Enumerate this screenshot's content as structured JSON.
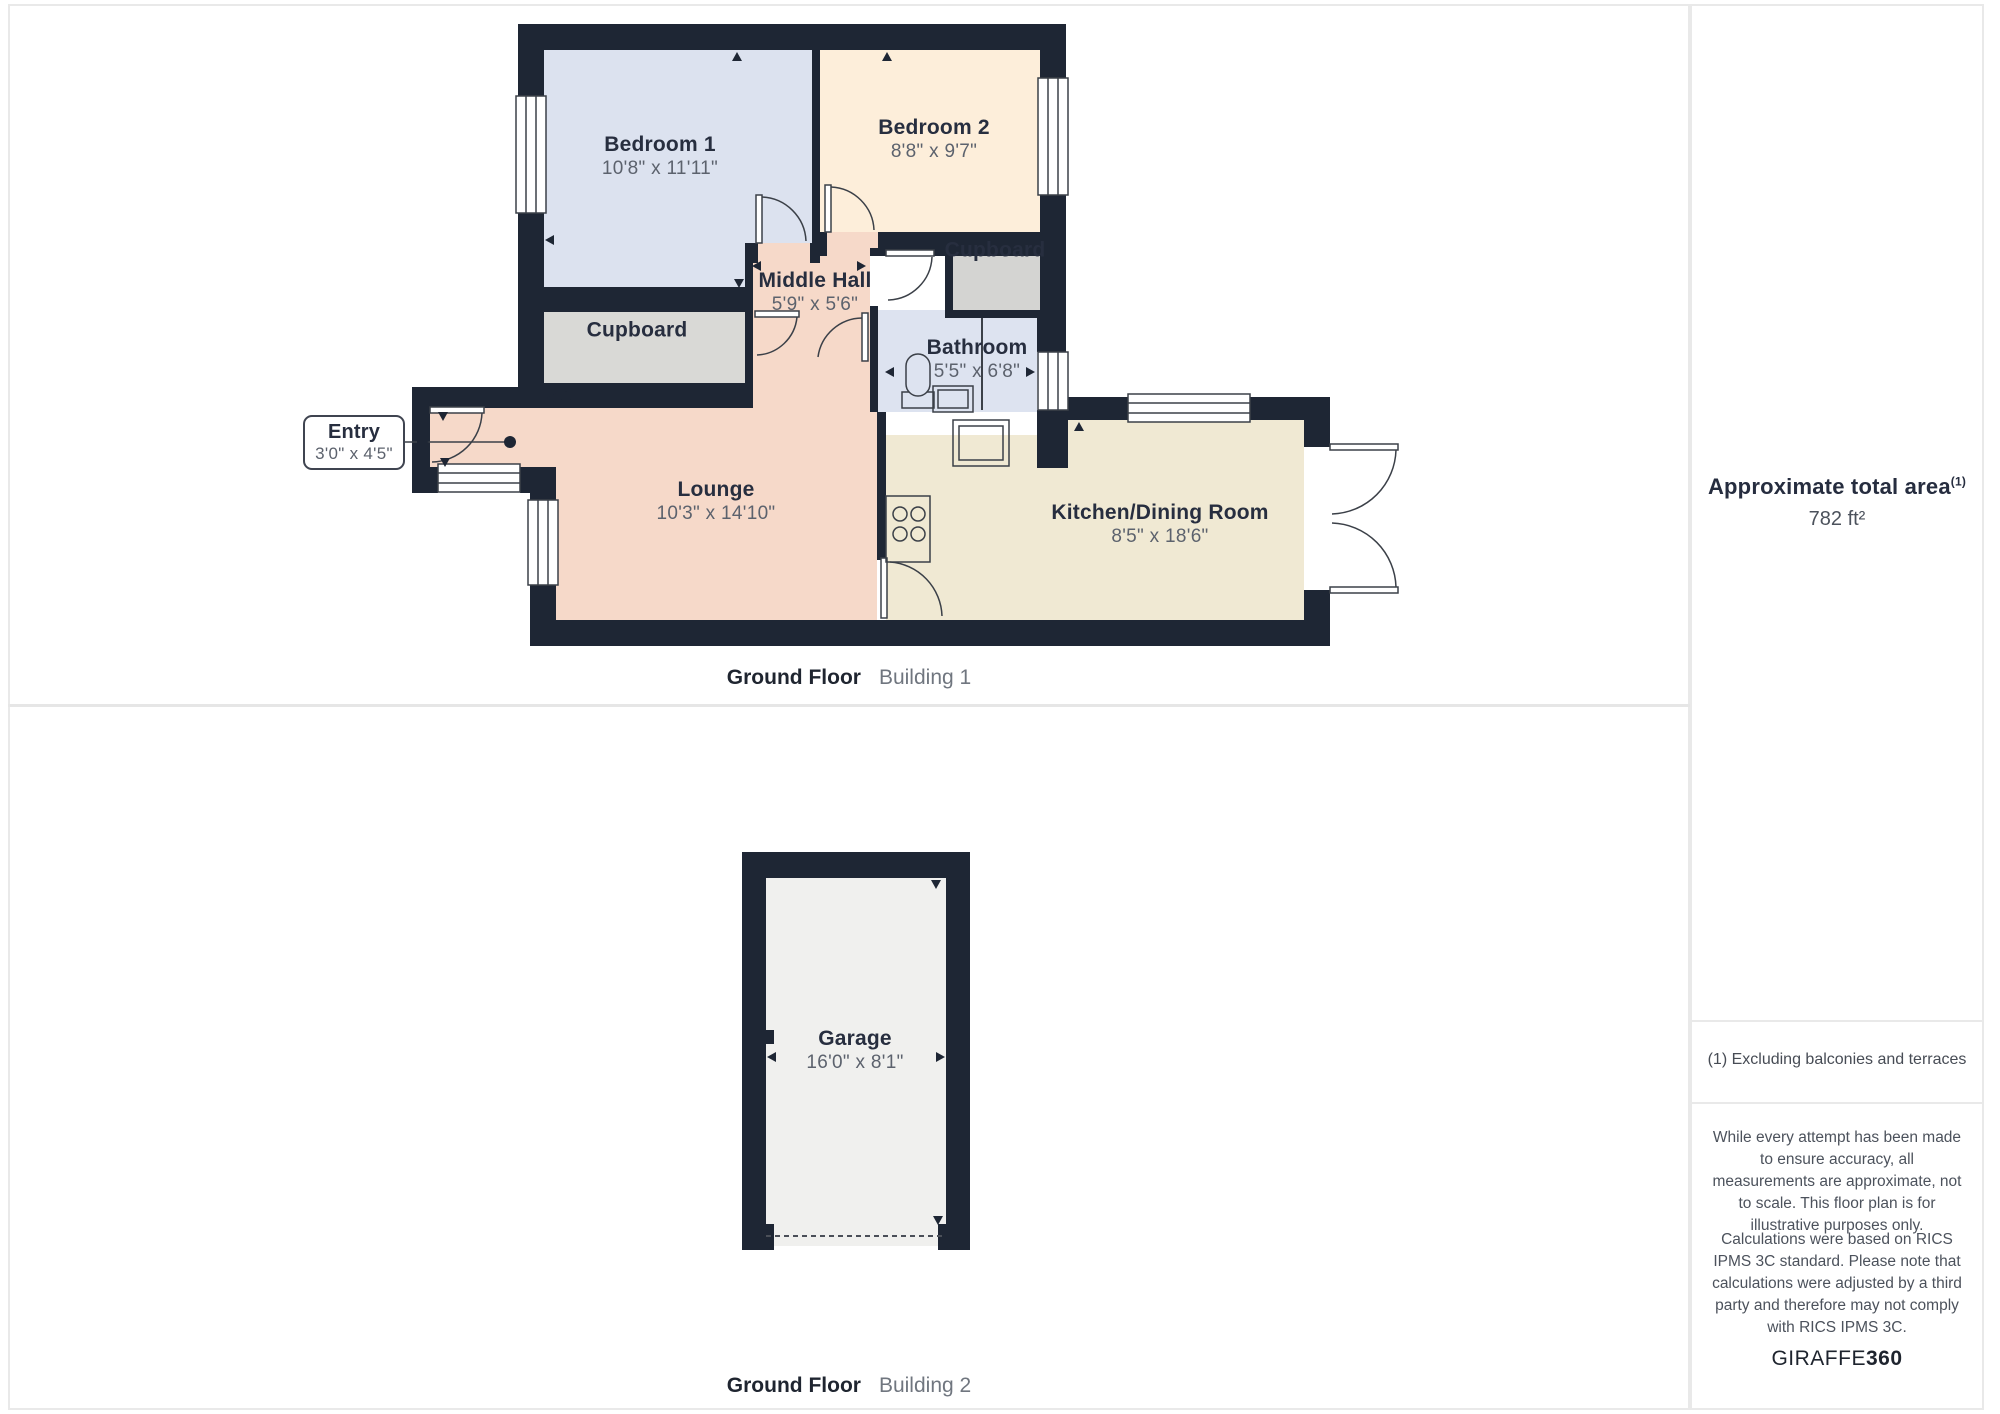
{
  "plan1": {
    "caption_bold": "Ground Floor",
    "caption_light": "Building 1",
    "rooms": [
      {
        "id": "bedroom1",
        "name": "Bedroom 1",
        "dims": "10'8\" x 11'11\""
      },
      {
        "id": "bedroom2",
        "name": "Bedroom 2",
        "dims": "8'8\" x 9'7\""
      },
      {
        "id": "middle_hall",
        "name": "Middle Hall",
        "dims": "5'9\" x 5'6\""
      },
      {
        "id": "cupboard_left",
        "name": "Cupboard",
        "dims": ""
      },
      {
        "id": "cupboard_top_right",
        "name": "Cupboard",
        "dims": ""
      },
      {
        "id": "bathroom",
        "name": "Bathroom",
        "dims": "5'5\" x 6'8\""
      },
      {
        "id": "lounge",
        "name": "Lounge",
        "dims": "10'3\" x 14'10\""
      },
      {
        "id": "kitchen_dining",
        "name": "Kitchen/Dining Room",
        "dims": "8'5\" x 18'6\""
      },
      {
        "id": "entry",
        "name": "Entry",
        "dims": "3'0\" x 4'5\""
      }
    ]
  },
  "plan2": {
    "caption_bold": "Ground Floor",
    "caption_light": "Building 2",
    "rooms": [
      {
        "id": "garage",
        "name": "Garage",
        "dims": "16'0\" x 8'1\""
      }
    ]
  },
  "sidebar": {
    "area_title": "Approximate total area",
    "area_superscript": "(1)",
    "area_value": "782 ft²",
    "footnote": "(1) Excluding balconies and terraces",
    "disclaimer1": "While every attempt has been made to ensure accuracy, all measurements are approximate, not to scale. This floor plan is for illustrative purposes only.",
    "disclaimer2": "Calculations were based on RICS IPMS 3C standard. Please note that calculations were adjusted by a third party and therefore may not comply with RICS IPMS 3C.",
    "brand_regular": "GIRAFFE",
    "brand_bold": "360"
  },
  "colors": {
    "wall": "#1e2634",
    "bedroom_fill": "#dce2ef",
    "bedroom2_fill": "#fdeeda",
    "hall_lounge_fill": "#f6d9c9",
    "cupboard_fill": "#d9d9d6",
    "bathroom_fill": "#dde3f0",
    "kitchen_fill": "#f0e9d3",
    "garage_fill": "#f0f0ee",
    "line": "#3b4048",
    "panel_border": "#e9e9e9"
  }
}
